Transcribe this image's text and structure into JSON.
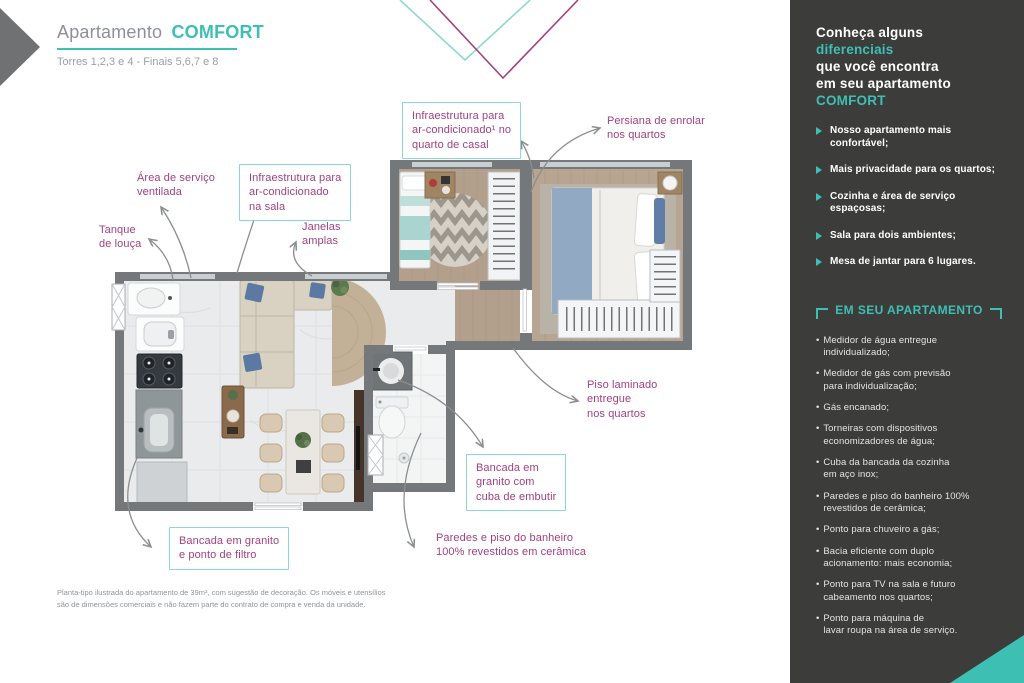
{
  "header": {
    "title_prefix": "Apartamento",
    "title_highlight": "COMFORT",
    "subtitle": "Torres 1,2,3 e 4 - Finais 5,6,7 e 8"
  },
  "colors": {
    "teal_accent": "#3ebfb4",
    "teal_light_border": "#8ed7d0",
    "magenta_label": "#a3417e",
    "sidebar_background": "#3c3c3a",
    "wall_gray": "#75787b"
  },
  "callouts": [
    {
      "id": "infra-quarto",
      "text": "Infraestrutura para\nar-condicionado¹ no\nquarto de casal",
      "boxed": true
    },
    {
      "id": "persiana",
      "text": "Persiana de enrolar\nnos quartos",
      "boxed": false
    },
    {
      "id": "area-servico",
      "text": "Área de serviço\nventilada",
      "boxed": false
    },
    {
      "id": "infra-sala",
      "text": "Infraestrutura para\nar-condicionado\nna sala",
      "boxed": true
    },
    {
      "id": "tanque",
      "text": "Tanque\nde louça",
      "boxed": false
    },
    {
      "id": "janelas",
      "text": "Janelas\namplas",
      "boxed": false
    },
    {
      "id": "piso-laminado",
      "text": "Piso laminado\nentregue\nnos quartos",
      "boxed": false
    },
    {
      "id": "bancada-cuba",
      "text": "Bancada em\ngranito com\ncuba de embutir",
      "boxed": true
    },
    {
      "id": "bancada-filtro",
      "text": "Bancada em granito\ne ponto de filtro",
      "boxed": true
    },
    {
      "id": "paredes-banheiro",
      "text": "Paredes e piso do banheiro\n100% revestidos em cerâmica",
      "boxed": false
    }
  ],
  "sidebar": {
    "intro": {
      "line1": "Conheça alguns",
      "line2": "diferenciais",
      "line3": "que você encontra",
      "line4": "em seu apartamento",
      "line5": "COMFORT"
    },
    "differentials": [
      "Nosso apartamento mais confortável;",
      "Mais privacidade para os quartos;",
      "Cozinha e área de serviço espaçosas;",
      "Sala para dois ambientes;",
      "Mesa de jantar para 6 lugares."
    ],
    "section_title": "EM SEU APARTAMENTO",
    "features": [
      "Medidor de água entregue\nindividualizado;",
      "Medidor de gás com previsão\npara individualização;",
      "Gás encanado;",
      "Torneiras com dispositivos\neconomizadores de água;",
      "Cuba da bancada da cozinha\nem aço inox;",
      "Paredes e piso do banheiro 100%\nrevestidos de cerâmica;",
      "Ponto para chuveiro a gás;",
      "Bacia eficiente com duplo\nacionamento: mais economia;",
      "Ponto para TV na sala e futuro\ncabeamento nos quartos;",
      "Ponto para máquina de\nlavar roupa na área de serviço."
    ]
  },
  "footer": {
    "disclaimer": "Planta-tipo ilustrada do apartamento de 39m², com sugestão de decoração. Os móveis e utensílios\nsão de dimensões comerciais e não fazem parte do contrato de compra e venda da unidade."
  }
}
